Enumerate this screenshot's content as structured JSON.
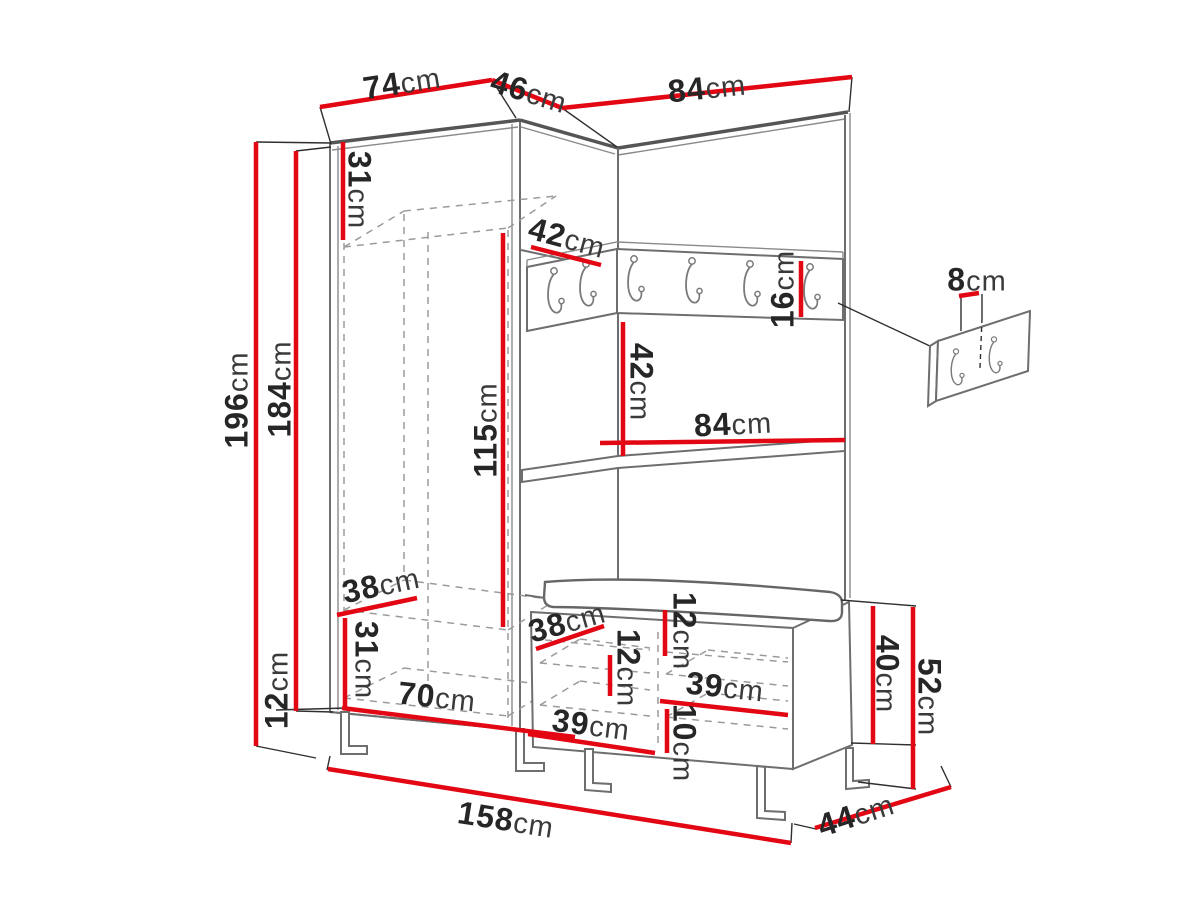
{
  "figure": {
    "kind": "furniture-dimension-diagram",
    "subject": "hallway set: corner wardrobe with hook rail, open shelf and shoe bench with cushion, plus separate wall hook panel",
    "unit": "cm",
    "accent_color": "#e30613",
    "outline_color": "#6e6e6e",
    "hook_rail": {
      "hook_count": 6
    },
    "wall_panel": {
      "hook_count": 2
    }
  },
  "dimensions": [
    {
      "id": "top-width-left",
      "value": "74",
      "unit": "cm"
    },
    {
      "id": "top-width-corner",
      "value": "46",
      "unit": "cm"
    },
    {
      "id": "top-width-right",
      "value": "84",
      "unit": "cm"
    },
    {
      "id": "upper-shelf-height",
      "value": "31",
      "unit": "cm"
    },
    {
      "id": "total-height",
      "value": "196",
      "unit": "cm"
    },
    {
      "id": "carcass-height",
      "value": "184",
      "unit": "cm"
    },
    {
      "id": "leg-height",
      "value": "12",
      "unit": "cm"
    },
    {
      "id": "hanging-space-height",
      "value": "115",
      "unit": "cm"
    },
    {
      "id": "corner-shelf-depth",
      "value": "42",
      "unit": "cm"
    },
    {
      "id": "hook-rail-height",
      "value": "16",
      "unit": "cm"
    },
    {
      "id": "open-shelf-height",
      "value": "42",
      "unit": "cm"
    },
    {
      "id": "shelf-width",
      "value": "84",
      "unit": "cm"
    },
    {
      "id": "wall-panel-offset",
      "value": "8",
      "unit": "cm"
    },
    {
      "id": "bottom-shelf-depth",
      "value": "38",
      "unit": "cm"
    },
    {
      "id": "bottom-compartment-height",
      "value": "31",
      "unit": "cm"
    },
    {
      "id": "bottom-shelf-width",
      "value": "70",
      "unit": "cm"
    },
    {
      "id": "bench-shelf-depth",
      "value": "38",
      "unit": "cm"
    },
    {
      "id": "cushion-height",
      "value": "12",
      "unit": "cm"
    },
    {
      "id": "bench-shelf-spacing",
      "value": "12",
      "unit": "cm"
    },
    {
      "id": "bench-compartment-right",
      "value": "39",
      "unit": "cm"
    },
    {
      "id": "bench-bottom-clearance",
      "value": "10",
      "unit": "cm"
    },
    {
      "id": "bench-compartment-left",
      "value": "39",
      "unit": "cm"
    },
    {
      "id": "bench-cabinet-height",
      "value": "40",
      "unit": "cm"
    },
    {
      "id": "bench-total-height",
      "value": "52",
      "unit": "cm"
    },
    {
      "id": "total-width",
      "value": "158",
      "unit": "cm"
    },
    {
      "id": "total-depth",
      "value": "44",
      "unit": "cm"
    }
  ]
}
